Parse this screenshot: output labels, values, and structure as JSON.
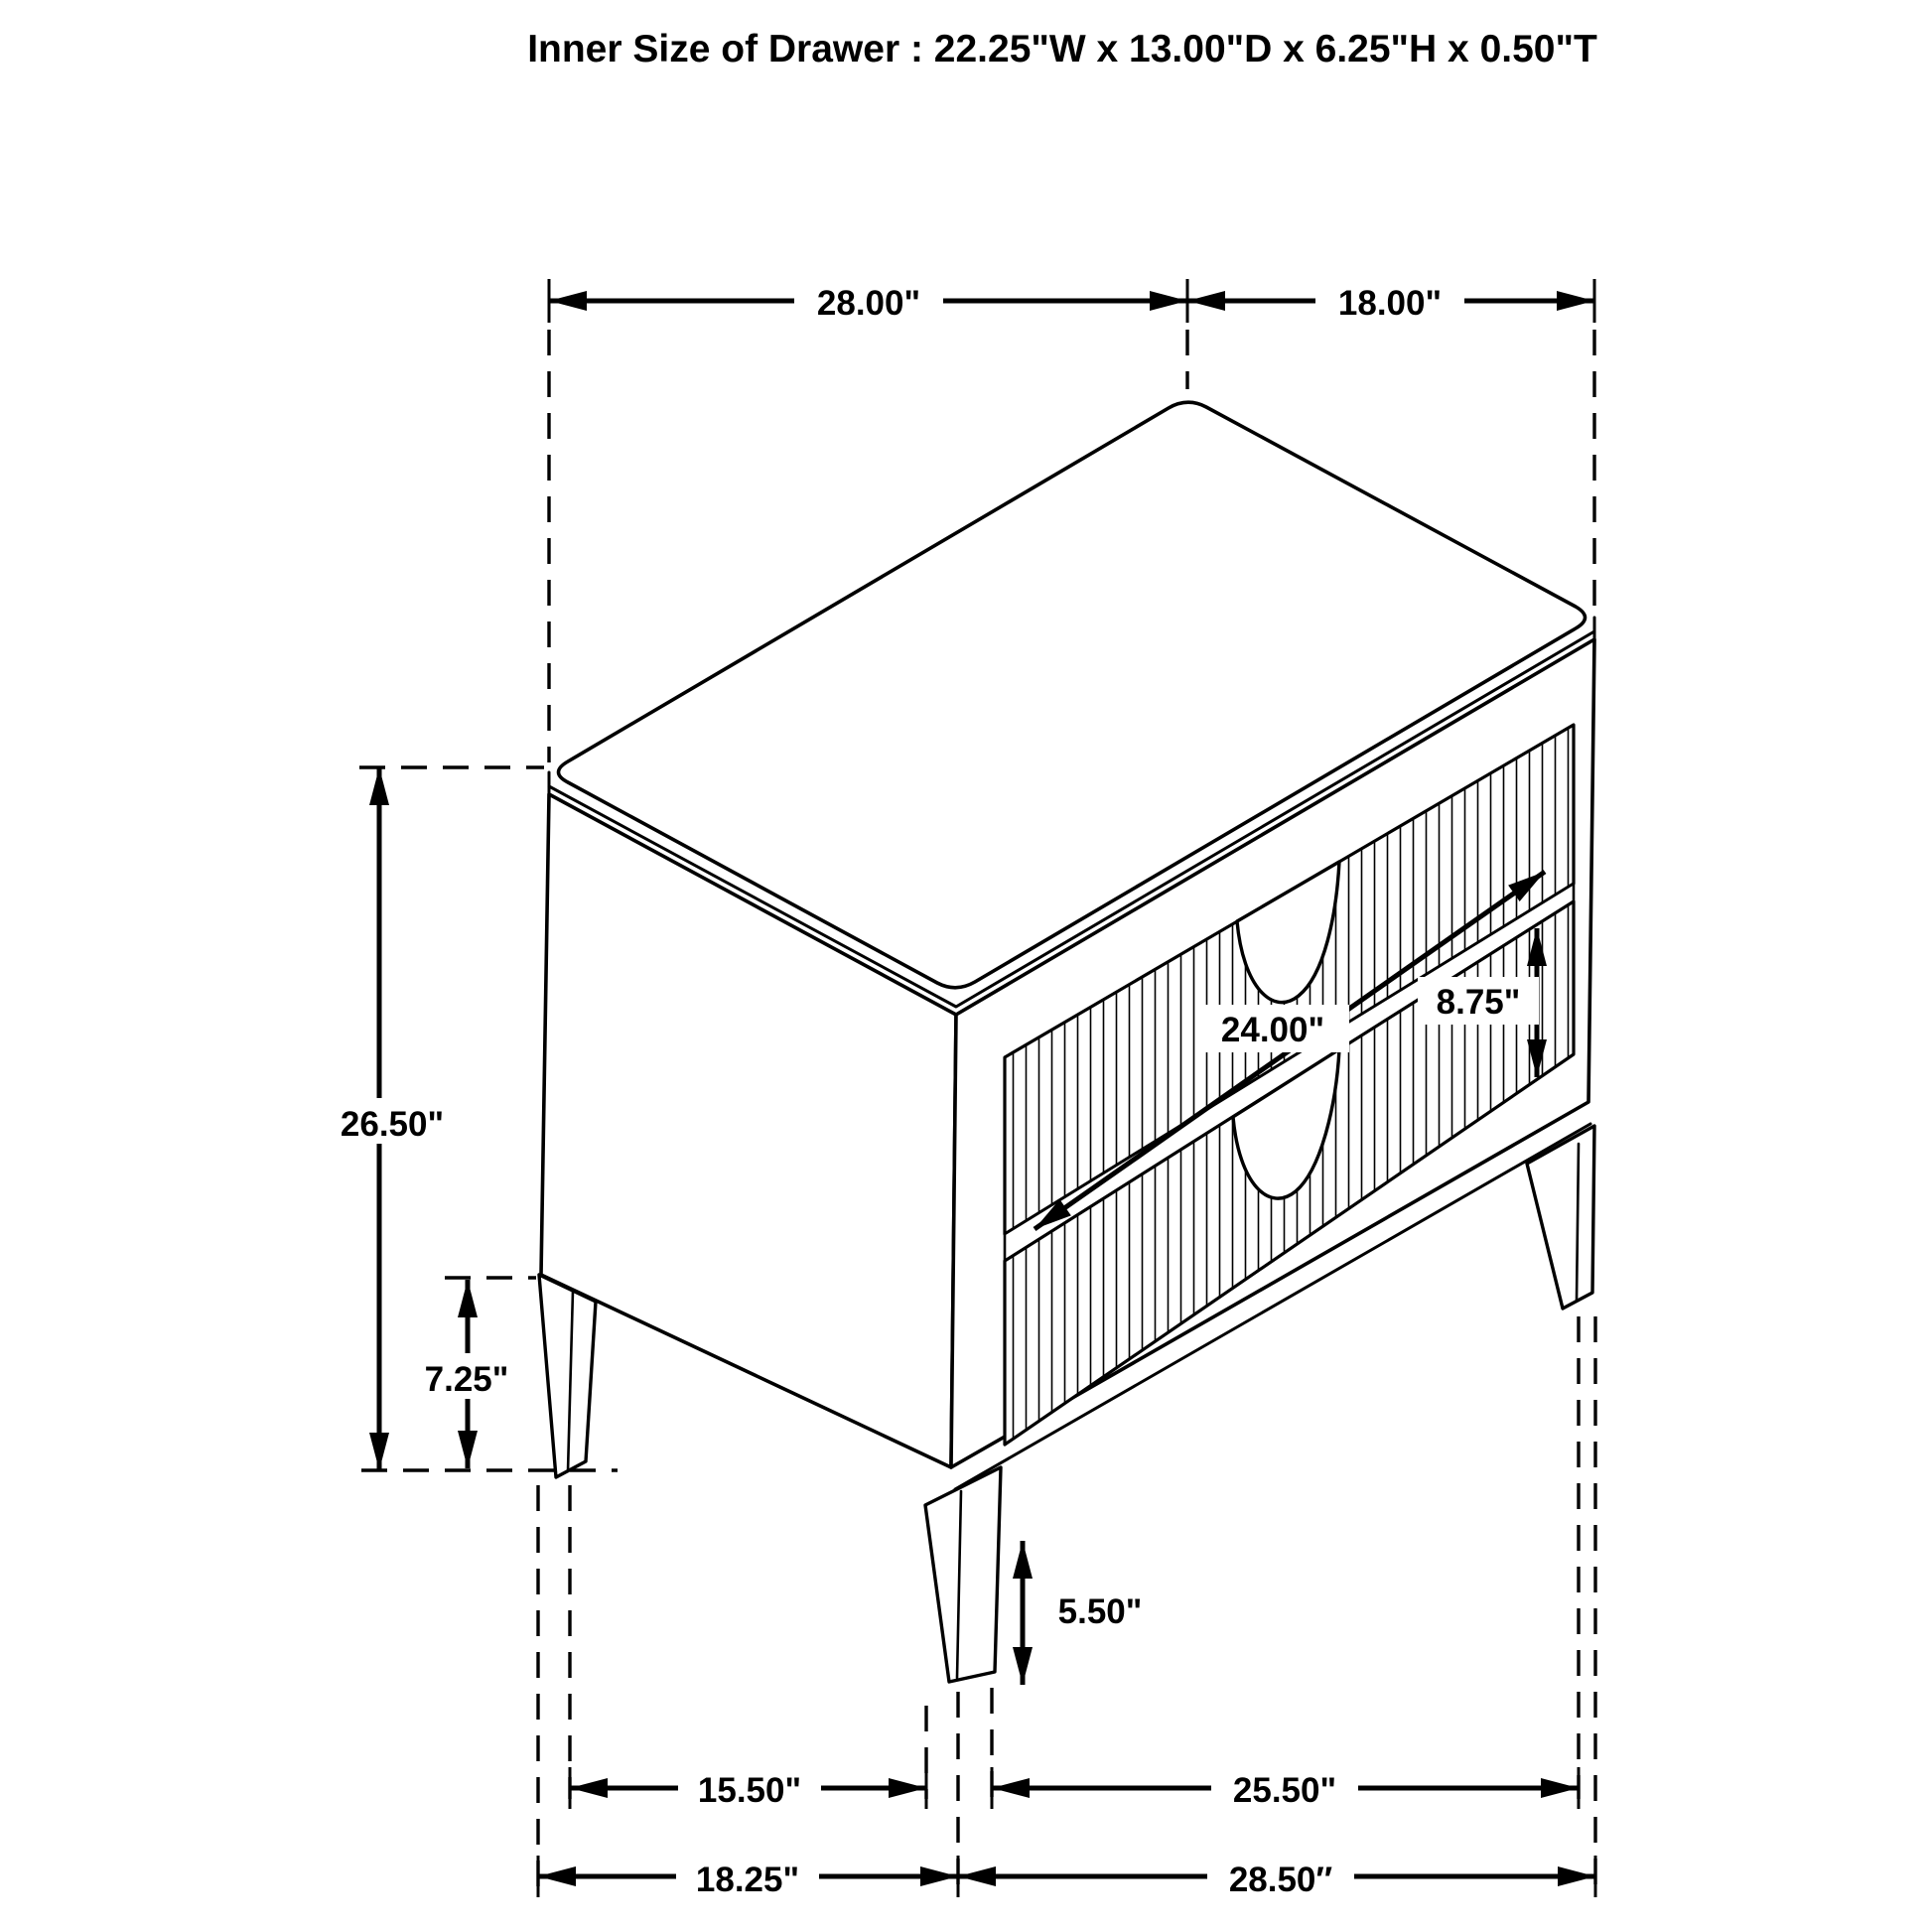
{
  "title": "Inner Size of Drawer : 22.25\"W x 13.00\"D x 6.25\"H x 0.50\"T",
  "colors": {
    "line": "#000000",
    "background": "#ffffff"
  },
  "dimensions": {
    "top_width": "28.00\"",
    "top_depth": "18.00\"",
    "overall_height": "26.50\"",
    "base_section_height": "7.25\"",
    "drawer_width": "24.00\"",
    "drawer_front_height": "8.75\"",
    "leg_height": "5.50\"",
    "front_leg_gap": "15.50\"",
    "side_leg_gap": "25.50\"",
    "base_depth": "18.25\"",
    "base_width": "28.50″"
  }
}
